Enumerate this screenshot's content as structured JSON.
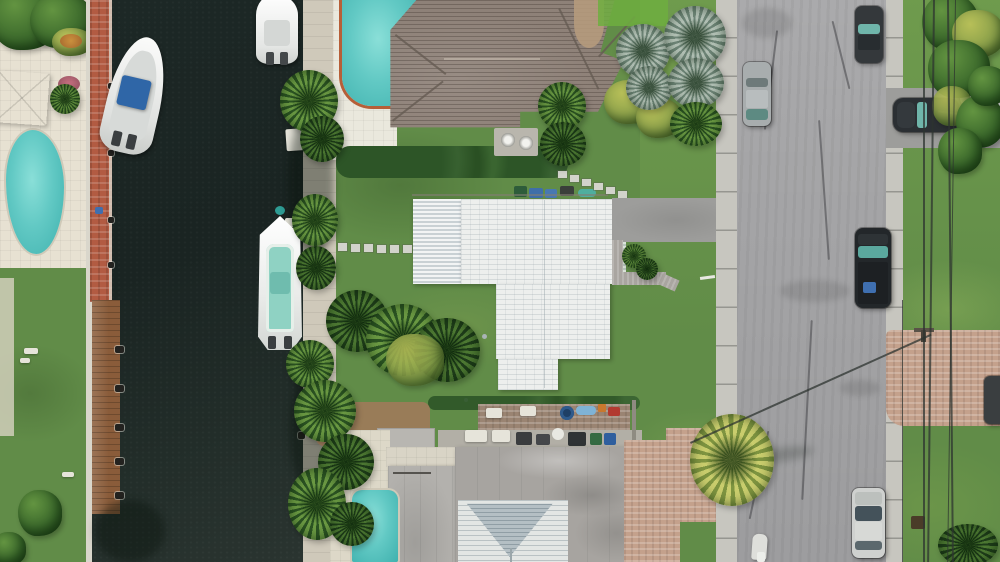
{
  "image_type": "aerial-drone-photograph",
  "description": "Top-down drone view of a waterfront residential neighborhood: a dark canal with docked boats on the left, three houses (brown tile roof top, white flat roof center, gray roof with white gable bottom), swimming pools, palm trees, and a gray street with parked cars on the right. No text is visible in the image.",
  "visible_text": [],
  "palette": {
    "water": "#1a2422",
    "grass": "#618c48",
    "grassBright": "#7aa751",
    "road": "#a5a5a7",
    "sidewalk": "#c7c6bf",
    "roofBrown": "#8e8178",
    "roofBrownDark": "#655b53",
    "roofWhite": "#edefed",
    "corrugA": "#f2f4f4",
    "corrugB": "#c9d1d4",
    "roofGray": "#a7a4a0",
    "gableWhite": "#e3e6e4",
    "gableBlue": "#b4bfc4",
    "poolTeal": "#62c9c4",
    "poolTealDark": "#3fb1ae",
    "brick": "#b25b42",
    "wood": "#8a5c3a",
    "paverPink": "#c4a18c",
    "paverGray": "#a9a5a0",
    "patio": "#e7e1d2",
    "boatWhite": "#f2f3f1",
    "boatCanopy": "#2f66a7",
    "boatTealDeck": "#8fd2c3",
    "carDark": "#34383b",
    "carSilver": "#a8adae",
    "carWhiteSilver": "#cfd1cf",
    "glassTeal": "#6fb5aa"
  },
  "scene": {
    "canal": {
      "orientation": "vertical",
      "boats_docked": 3
    },
    "boats": [
      {
        "name": "boat-white-blue-canopy",
        "hull": "white",
        "canopy": "blue"
      },
      {
        "name": "boat-white-top",
        "hull": "white"
      },
      {
        "name": "boat-teal-deck",
        "hull": "white",
        "deck": "mint-teal"
      }
    ],
    "buildings": [
      {
        "name": "house-brown-tile-roof",
        "position": "top-center"
      },
      {
        "name": "house-white-flat-roof",
        "position": "center"
      },
      {
        "name": "house-gray-roof-white-gable",
        "position": "bottom-center"
      }
    ],
    "pools": [
      {
        "name": "pool-left-property"
      },
      {
        "name": "pool-top-property"
      },
      {
        "name": "pool-bottom-property"
      }
    ],
    "street": {
      "orientation": "vertical",
      "sidewalks": 2,
      "vehicles": [
        {
          "name": "car-dark-top-right"
        },
        {
          "name": "car-silver-left"
        },
        {
          "name": "suv-black-driveway"
        },
        {
          "name": "jetski-boats-on-trailer"
        },
        {
          "name": "truck-dark-right"
        },
        {
          "name": "car-silver-bottom-right"
        },
        {
          "name": "car-dark-right-edge"
        }
      ]
    },
    "vegetation": [
      "palms-canal-bank",
      "bismarck-silver-palms",
      "fan-palm-street",
      "hedges",
      "round-bushes",
      "tropical-shrubs"
    ]
  }
}
